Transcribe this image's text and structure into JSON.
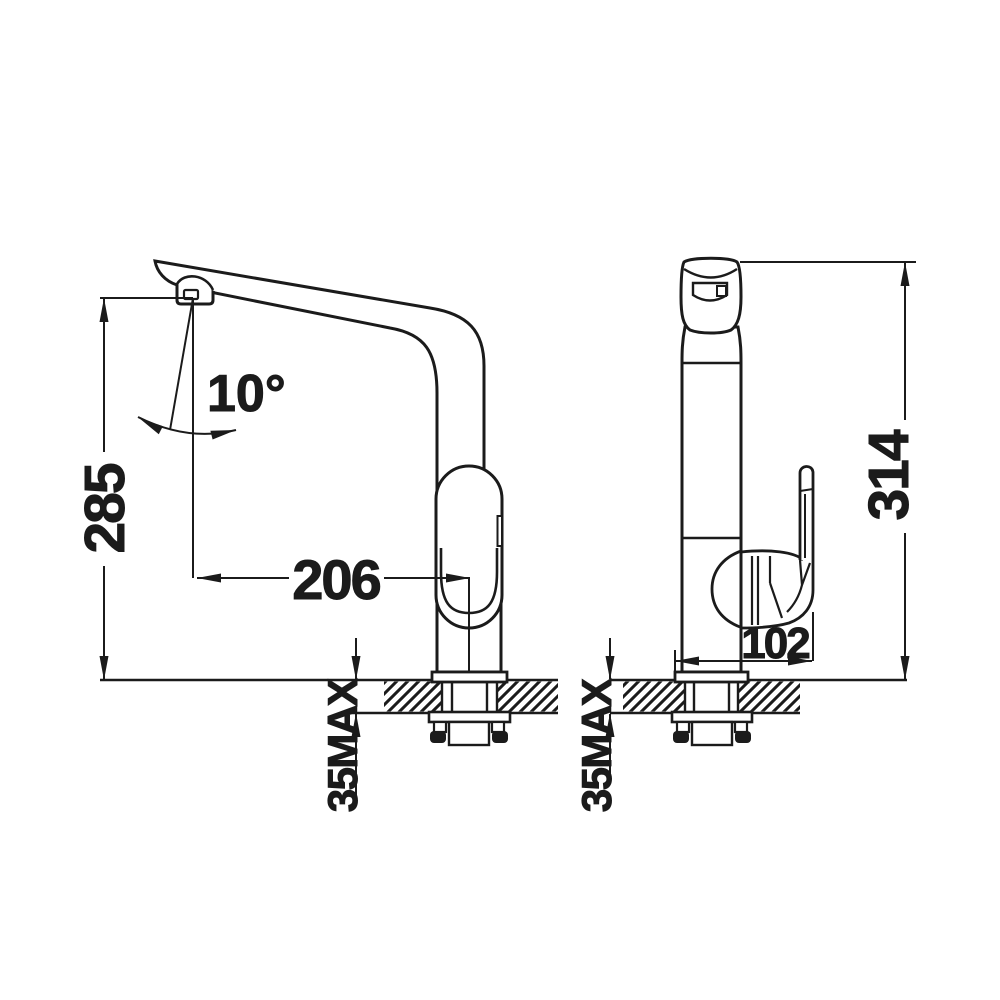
{
  "page": {
    "background": "#ffffff",
    "ink": "#1b1b1b"
  },
  "drawing": {
    "views": {
      "side": {
        "label_angle": "10°",
        "label_height": "285",
        "label_reach": "206",
        "label_deck": "35MAX"
      },
      "front": {
        "label_height": "314",
        "label_depth": "102",
        "label_deck": "35MAX"
      }
    }
  }
}
